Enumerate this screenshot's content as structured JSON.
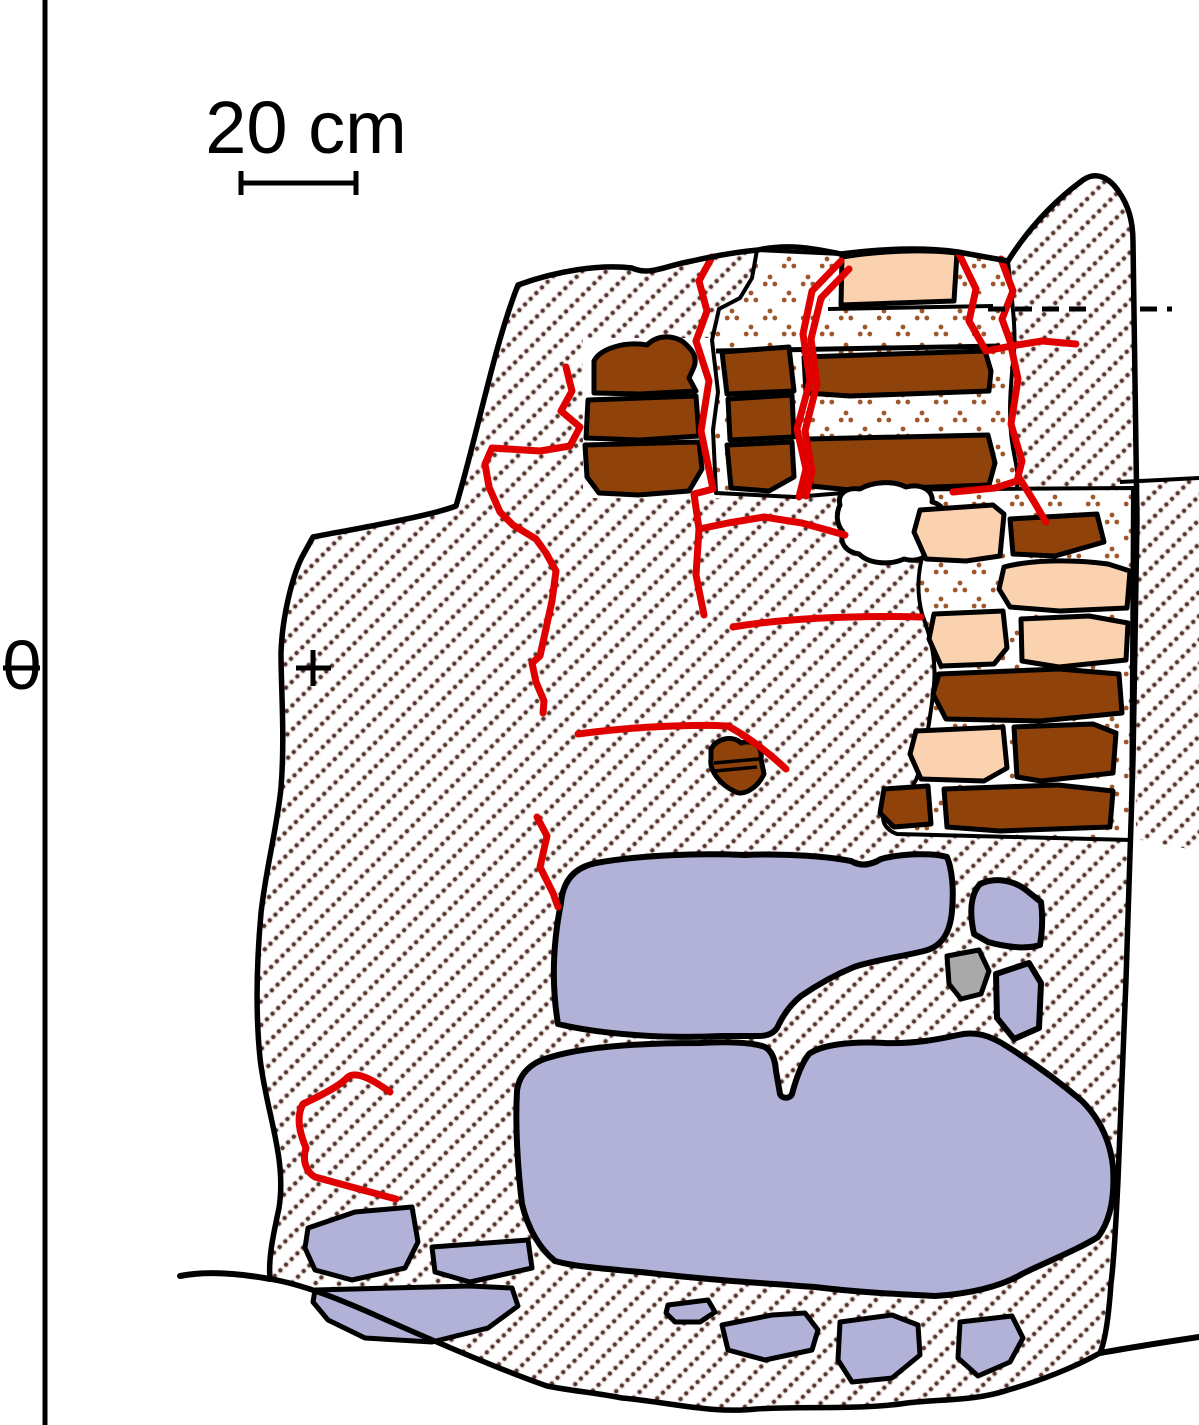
{
  "figure": {
    "scale_bar": {
      "label": "20 cm"
    },
    "datum": {
      "label": "0"
    },
    "colors": {
      "background": "#FFFFFF",
      "outline": "#000000",
      "brick": "#8F430A",
      "peach": "#FBD2AF",
      "purple": "#B2B2D8",
      "gray": "#A9A9A9",
      "crack": "#E10000",
      "hatch_dot": "#54352F",
      "hatch_halo": "#C9ADA5",
      "stipple_dot": "#A0562B"
    }
  }
}
